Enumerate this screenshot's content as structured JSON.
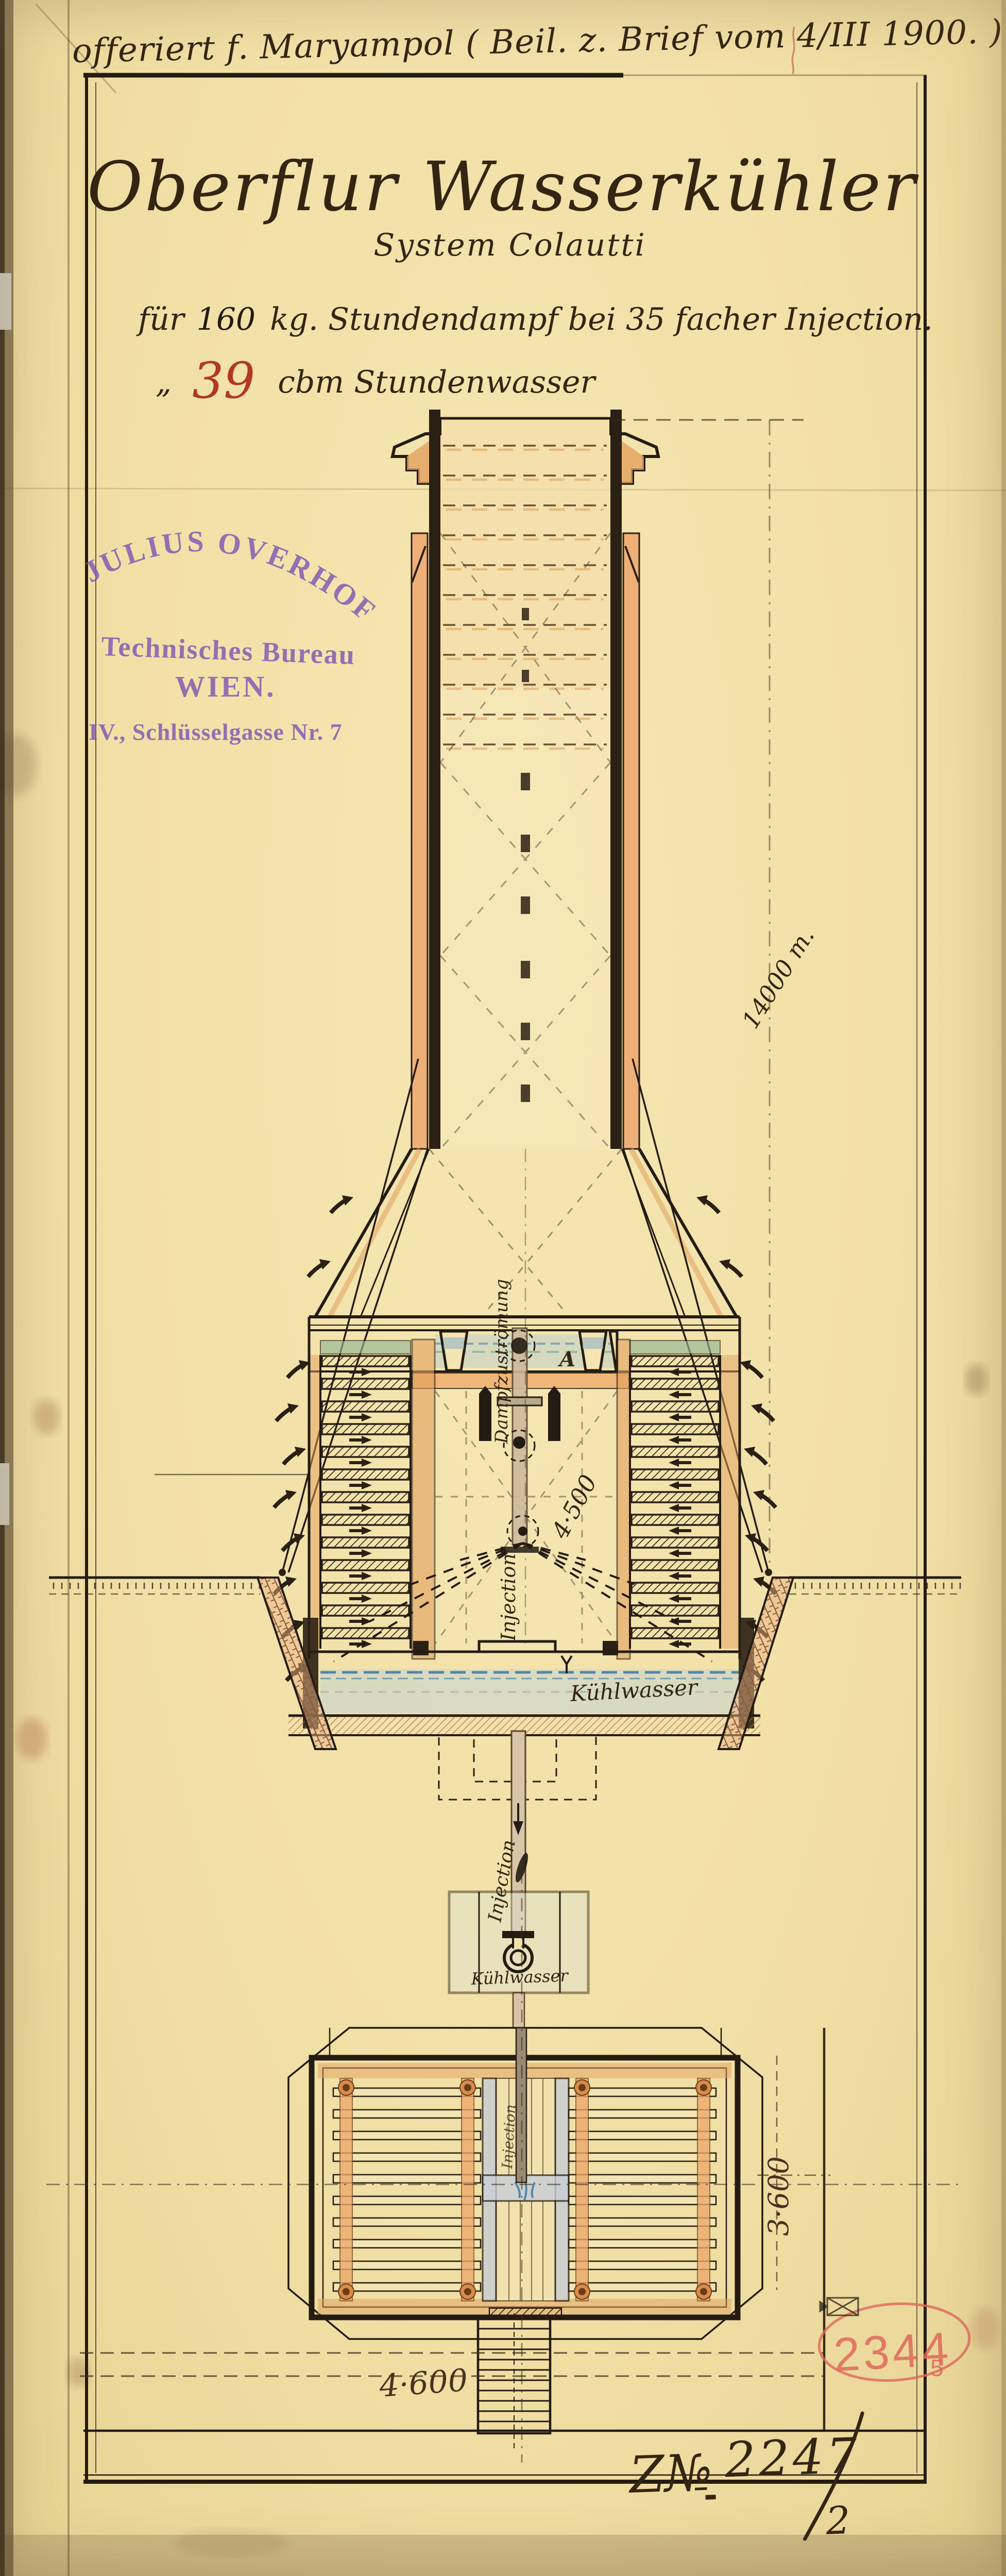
{
  "document": {
    "annotation_top": "offeriert f. Maryampol ( Beil. z. Brief vom 4/III 1900. )",
    "title": "Oberflur Wasserkühler",
    "subtitle": "System Colautti",
    "spec_line1": {
      "prefix": "für",
      "value": "160",
      "rest": "kg. Stundendampf bei 35 facher Injection."
    },
    "spec_line2": {
      "prefix": "„",
      "value": "39",
      "rest": "cbm Stundenwasser"
    },
    "drawing_number": {
      "prefix": "Z№",
      "number": "2247",
      "sheet": "2"
    }
  },
  "maker_stamp": {
    "name": "JULIUS OVERHOFF",
    "line2": "Technisches Bureau",
    "line3": "WIEN.",
    "line4": "IV., Schlüsselgasse Nr. 7"
  },
  "registry_stamp": {
    "number": "2344",
    "suffix": "5"
  },
  "labels": {
    "height_note": "14000 m.",
    "steam_pipe": "Dampfzuströmung",
    "injection_spray": "Injection",
    "injection_feed": "Injection",
    "plan_feed_pipe": "Injection",
    "spray_width": "4·500",
    "basin_water": "Kühlwasser",
    "inlet_water": "Kühlwasser",
    "section_marker": "A",
    "plan_width": "4·600",
    "plan_depth": "3·600"
  },
  "colors": {
    "paper": "#f1e1ab",
    "ink": "#2a2014",
    "wood": "#e2a05e",
    "water_blue": "#6f9cbb",
    "water_green": "#93b897",
    "stamp_purple": "#7d57b5",
    "stamp_red": "#de685a",
    "red_ink": "#b03a20"
  }
}
